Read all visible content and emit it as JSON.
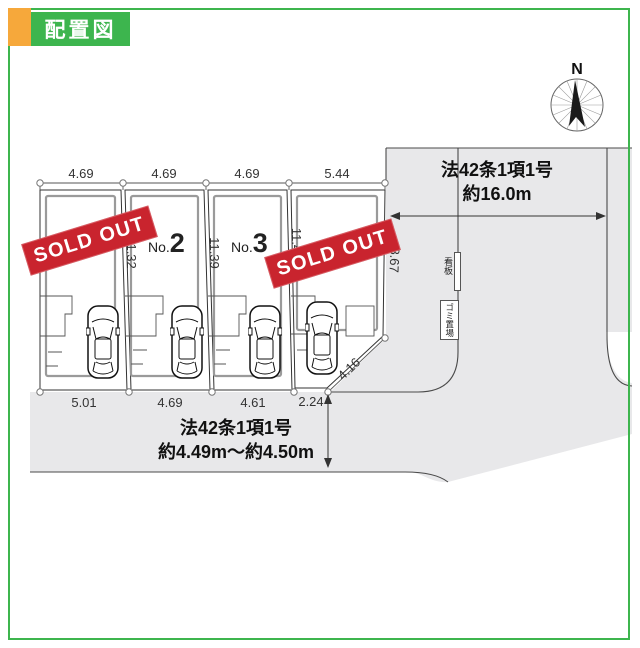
{
  "header": {
    "title": "配置図"
  },
  "colors": {
    "accent_green": "#3db54e",
    "accent_orange": "#f6a83b",
    "sold_red": "#c9242e",
    "road_gray": "#e8e8ea"
  },
  "compass": {
    "label": "N"
  },
  "banner": {
    "sold_out": "SOLD OUT"
  },
  "lots": [
    {
      "name": "lot-1",
      "sold": true
    },
    {
      "name": "lot-2",
      "label_prefix": "No.",
      "label_number": "2"
    },
    {
      "name": "lot-3",
      "label_prefix": "No.",
      "label_number": "3"
    },
    {
      "name": "lot-4",
      "sold": true
    }
  ],
  "dimensions": {
    "top": [
      "4.69",
      "4.69",
      "4.69",
      "5.44"
    ],
    "bottom": [
      "5.01",
      "4.69",
      "4.61",
      "2.24"
    ],
    "boundaries": [
      "11.32",
      "11.39",
      "11.4"
    ],
    "right_edge": "8.67",
    "diagonal": "4.16"
  },
  "roads": {
    "east": {
      "line1": "法42条1項1号",
      "line2": "約16.0m"
    },
    "south": {
      "line1": "法42条1項1号",
      "line2": "約4.49m～約4.50m"
    }
  },
  "landmarks": {
    "signboard": "看板",
    "garbage": "ゴミ置場"
  }
}
